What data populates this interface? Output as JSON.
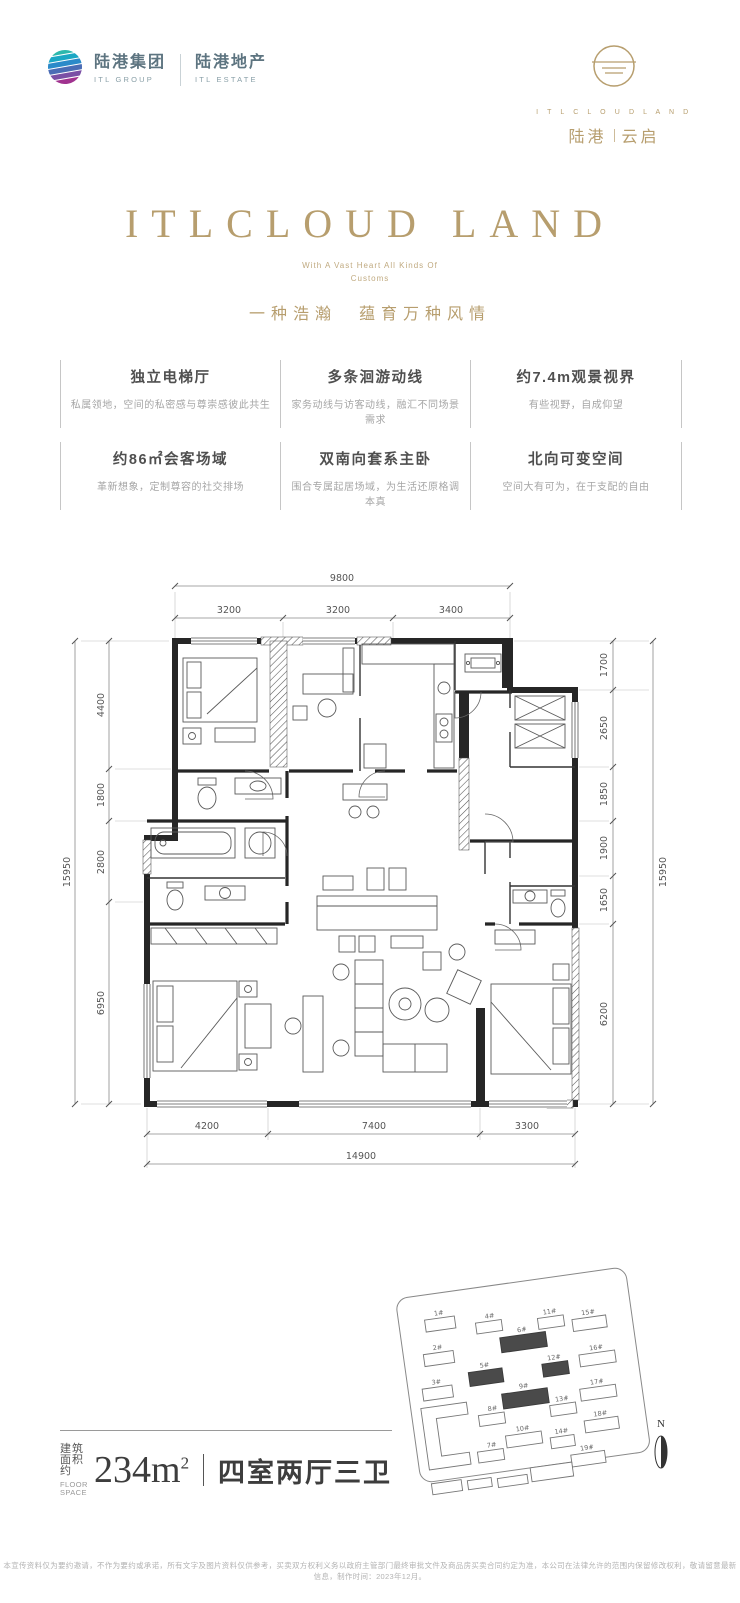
{
  "brand": {
    "group_cn": "陆港集团",
    "group_en": "ITL GROUP",
    "estate_cn": "陆港地产",
    "estate_en": "ITL ESTATE",
    "project_en": "I T L C L O U D L A N D",
    "project_cn_left": "陆港",
    "project_cn_right": "云启"
  },
  "hero": {
    "title": "ITLCLOUD LAND",
    "subtitle_line1": "With A Vast Heart All Kinds Of",
    "subtitle_line2": "Customs",
    "slogan": "一种浩瀚　蕴育万种风情"
  },
  "features": [
    {
      "title": "独立电梯厅",
      "desc": "私属领地，空间的私密感与尊崇感彼此共生"
    },
    {
      "title": "多条洄游动线",
      "desc": "家务动线与访客动线，融汇不同场景需求"
    },
    {
      "title": "约7.4m观景视界",
      "desc": "有些视野，自成仰望"
    },
    {
      "title": "约86㎡会客场域",
      "desc": "革新想象，定制尊容的社交排场"
    },
    {
      "title": "双南向套系主卧",
      "desc": "围合专属起居场域，为生活还原格调本真"
    },
    {
      "title": "北向可变空间",
      "desc": "空间大有可为，在于支配的自由"
    }
  ],
  "floorplan": {
    "dims": {
      "top_total": "9800",
      "top": [
        "3200",
        "3200",
        "3400"
      ],
      "left_total": "15950",
      "left": [
        "4400",
        "1800",
        "2800",
        "6950"
      ],
      "right": [
        "1700",
        "2650",
        "1850",
        "1900",
        "1650",
        "6200"
      ],
      "right_total": "15950",
      "bottom": [
        "4200",
        "7400",
        "3300"
      ],
      "bottom_total": "14900"
    }
  },
  "summary": {
    "area_label_cn": "建筑面积约",
    "area_label_en": "FLOOR SPACE",
    "area_value": "234m",
    "area_sup": "2",
    "divider": "",
    "layout": "四室两厅三卫"
  },
  "siteplan": {
    "buildings": [
      {
        "label": "1#"
      },
      {
        "label": "2#"
      },
      {
        "label": "3#"
      },
      {
        "label": "4#"
      },
      {
        "label": "5#"
      },
      {
        "label": "6#"
      },
      {
        "label": "7#"
      },
      {
        "label": "8#"
      },
      {
        "label": "9#"
      },
      {
        "label": "10#"
      },
      {
        "label": "11#"
      },
      {
        "label": "12#"
      },
      {
        "label": "13#"
      },
      {
        "label": "14#"
      },
      {
        "label": "15#"
      },
      {
        "label": "16#"
      },
      {
        "label": "17#"
      },
      {
        "label": "18#"
      },
      {
        "label": "19#"
      }
    ],
    "highlighted": [
      "5#",
      "6#",
      "9#",
      "12#"
    ],
    "compass": "N"
  },
  "footer": {
    "disclaimer": "本宣传资料仅为要约邀请，不作为要约或承诺，所有文字及图片资料仅供参考，买卖双方权利义务以政府主管部门最终审批文件及商品房买卖合同约定为准，本公司在法律允许的范围内保留修改权利，敬请留意最新信息，制作时间：2023年12月。"
  },
  "colors": {
    "gold": "#b79e6e",
    "logo_text": "#5d7480",
    "wall": "#262626",
    "highlight_building": "#4a4a4a"
  }
}
